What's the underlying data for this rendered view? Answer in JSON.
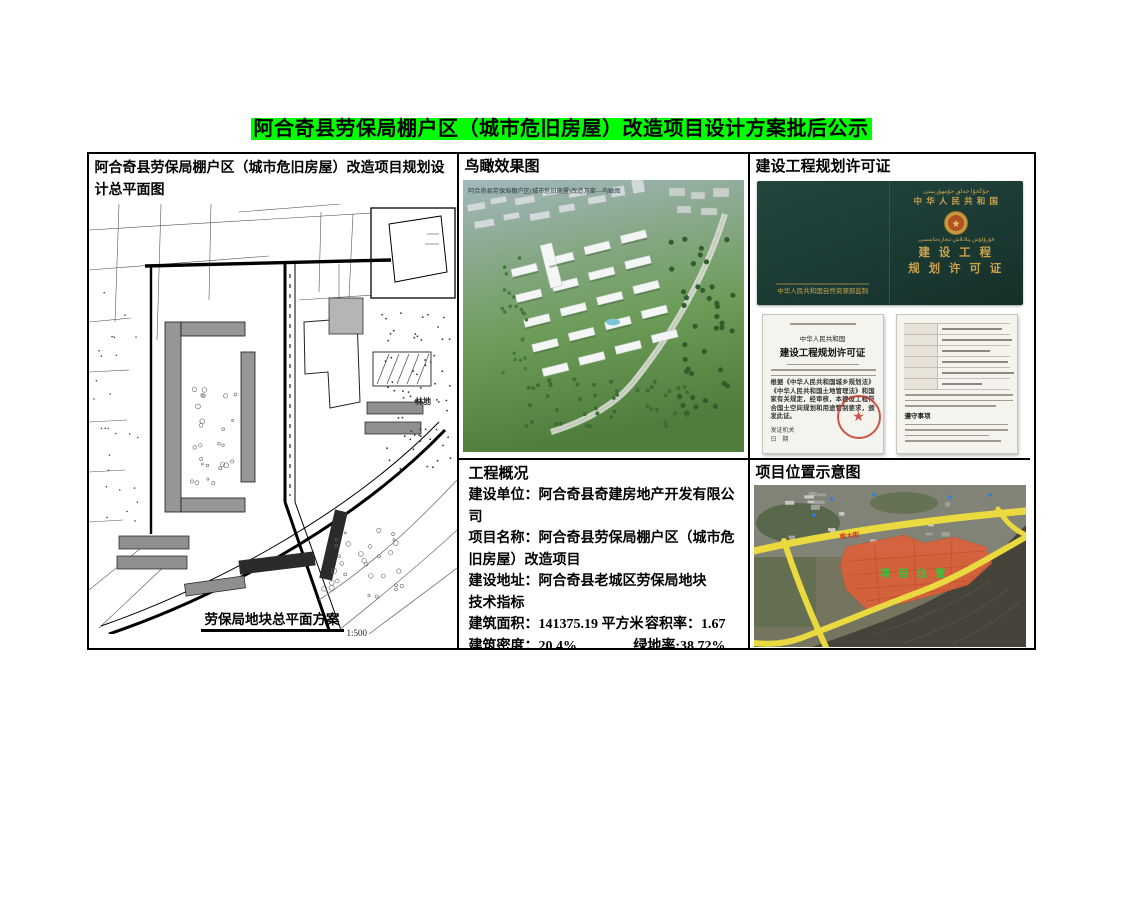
{
  "page": {
    "title": "阿合奇县劳保局棚户区（城市危旧房屋）改造项目设计方案批后公示",
    "highlight_color": "#00ff00"
  },
  "site_plan": {
    "title": "阿合奇县劳保局棚户区（城市危旧房屋）改造项目规划设计总平面图",
    "caption": "劳保局地块总平面方案",
    "scale": "1:500",
    "land_label": "林地"
  },
  "aerial": {
    "title": "鸟瞰效果图",
    "overlay_caption": "阿合奇县劳保局棚户区(城市危旧房屋)改造方案—鸟瞰图"
  },
  "permit": {
    "title": "建设工程规划许可证",
    "cover": {
      "uyghur_top": "جۇڭخۇا خەلق جۇمھۇرىيىتى",
      "country": "中 华 人 民 共 和 国",
      "uyghur_mid": "قۇرۇلۇش پىلانلاش ئىجازەتنامىسى",
      "title_line1": "建 设 工 程",
      "title_line2": "规 划 许 可 证",
      "publisher": "中华人民共和国自然资源部监制"
    },
    "doc_left": {
      "header": "中华人民共和国",
      "title": "建设工程规划许可证",
      "body": "根据《中华人民共和国城乡规划法》《中华人民共和国土地管理法》和国家有关规定，经审核，本建设工程符合国土空间规划和用途管制要求，颁发此证。",
      "issuer_label": "发证机关",
      "date_label": "日　期"
    },
    "doc_right": {
      "notes_title": "遵守事项"
    }
  },
  "overview": {
    "title": "工程概况",
    "rows": [
      {
        "text": "建设单位：阿合奇县奇建房地产开发有限公司"
      },
      {
        "text": "项目名称：阿合奇县劳保局棚户区（城市危旧房屋）改造项目"
      },
      {
        "text": "建设地址：阿合奇县老城区劳保局地块"
      },
      {
        "text": "技术指标"
      },
      {
        "left": "建筑面积：141375.19 平方米",
        "right": "容积率：1.67"
      },
      {
        "left": "建筑密度：20.4%",
        "right": "绿地率:38.72%"
      },
      {
        "text": "停车位：782 个（其中地上 0 个，地下 782 个）"
      }
    ]
  },
  "location": {
    "title": "项目位置示意图",
    "area_label": "项 目 位 置",
    "road_label": "南大街"
  }
}
